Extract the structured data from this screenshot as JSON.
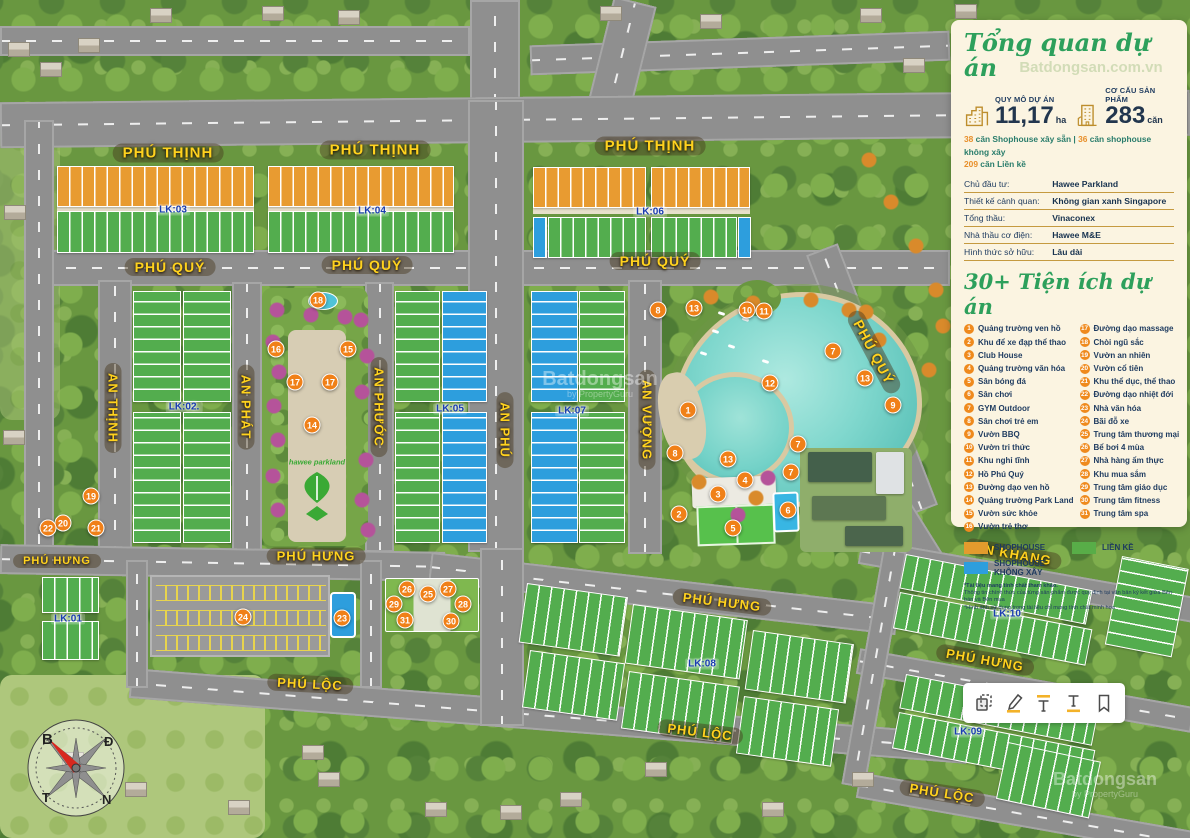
{
  "panel": {
    "title": "Tổng quan dự án",
    "stats": [
      {
        "icon": "city-skyline-icon",
        "label": "QUY MÔ DỰ ÁN",
        "value": "11,17",
        "unit": "ha"
      },
      {
        "icon": "building-icon",
        "label": "CƠ CẤU SẢN PHẨM",
        "value": "283",
        "unit": "căn"
      }
    ],
    "mix": {
      "a_num": "38",
      "a_text": " căn Shophouse xây sẵn",
      "sep": " | ",
      "b_num": "36",
      "b_text": " căn shophouse không xây",
      "c_num": "209",
      "c_text": " căn Liền kề"
    },
    "details": [
      {
        "label": "Chủ đầu tư:",
        "value": "Hawee Parkland"
      },
      {
        "label": "Thiết kế cảnh quan:",
        "value": "Không gian xanh Singapore"
      },
      {
        "label": "Tổng thầu:",
        "value": "Vinaconex"
      },
      {
        "label": "Nhà thầu cơ điện:",
        "value": "Hawee M&E"
      },
      {
        "label": "Hình thức sở hữu:",
        "value": "Lâu dài"
      }
    ],
    "amenities_title": "30+ Tiện ích dự án",
    "amenities": [
      "Quảng trường ven hồ",
      "Khu để xe đạp thể thao",
      "Club House",
      "Quảng trường văn hóa",
      "Sân bóng đá",
      "Sân chơi",
      "GYM Outdoor",
      "Sân chơi trẻ em",
      "Vườn BBQ",
      "Vườn tri thức",
      "Khu nghỉ tĩnh",
      "Hồ Phú Quý",
      "Đường dạo ven hồ",
      "Quảng trường Park Land",
      "Vườn sức khỏe",
      "Vườn trẻ thơ",
      "Đường dạo massage",
      "Chòi ngũ sắc",
      "Vườn an nhiên",
      "Vườn cổ tiên",
      "Khu thể dục, thể thao",
      "Đường dạo nhiệt đới",
      "Nhà văn hóa",
      "Bãi đỗ xe",
      "Trung tâm thương mại",
      "Bể bơi 4 mùa",
      "Nhà hàng ẩm thực",
      "Khu mua sắm",
      "Trung tâm giáo dục",
      "Trung tâm fitness",
      "Trung tâm spa"
    ],
    "legend": [
      {
        "label": "SHOPHOUSE",
        "color": "#e39b2d"
      },
      {
        "label": "LIỀN KỀ",
        "color": "#58ad48"
      },
      {
        "label": "SHOPHOUSE KHÔNG XÂY",
        "color": "#2d9edd"
      }
    ],
    "disclaimer": [
      "*Tài liệu mang tính chất tham khảo.",
      "Thông tin chính thức của từng sản phẩm được quy định tại văn bản ký kết giữa Bên bán và Bên mua",
      "*Hình ảnh sử dụng trong tài liệu chỉ mang tính chất minh họa"
    ]
  },
  "map": {
    "logo": "hawee parkland",
    "compass": {
      "tl": "B",
      "tr": "Đ",
      "bl": "T",
      "br": "N"
    },
    "watermark": {
      "brand": "Batdongsan",
      "domain": ".com.vn",
      "byline": "by PropertyGuru"
    },
    "streets": [
      {
        "t": "PHÚ THỊNH",
        "x": 168,
        "y": 153,
        "r": 0,
        "s": 15
      },
      {
        "t": "PHÚ THỊNH",
        "x": 375,
        "y": 150,
        "r": 0,
        "s": 15
      },
      {
        "t": "PHÚ THỊNH",
        "x": 650,
        "y": 146,
        "r": 0,
        "s": 15
      },
      {
        "t": "PHÚ QUÝ",
        "x": 170,
        "y": 267,
        "r": 0,
        "s": 14
      },
      {
        "t": "PHÚ QUÝ",
        "x": 367,
        "y": 265,
        "r": 0,
        "s": 14
      },
      {
        "t": "PHÚ QUÝ",
        "x": 655,
        "y": 261,
        "r": 0,
        "s": 14
      },
      {
        "t": "PHÚ QUÝ",
        "x": 874,
        "y": 352,
        "r": 62,
        "s": 14
      },
      {
        "t": "AN THỊNH",
        "x": 113,
        "y": 408,
        "r": 90,
        "s": 13
      },
      {
        "t": "AN PHÁT",
        "x": 246,
        "y": 407,
        "r": 90,
        "s": 13
      },
      {
        "t": "AN PHƯỚC",
        "x": 379,
        "y": 407,
        "r": 90,
        "s": 13
      },
      {
        "t": "AN PHÚ",
        "x": 505,
        "y": 430,
        "r": 90,
        "s": 13
      },
      {
        "t": "AN VƯỢNG",
        "x": 647,
        "y": 420,
        "r": 90,
        "s": 13
      },
      {
        "t": "PHÚ HƯNG",
        "x": 57,
        "y": 561,
        "r": 0,
        "s": 11
      },
      {
        "t": "PHÚ HƯNG",
        "x": 316,
        "y": 556,
        "r": 0,
        "s": 13
      },
      {
        "t": "PHÚ HƯNG",
        "x": 722,
        "y": 602,
        "r": 7,
        "s": 13
      },
      {
        "t": "PHÚ HƯNG",
        "x": 985,
        "y": 660,
        "r": 10,
        "s": 13
      },
      {
        "t": "AN KHANG",
        "x": 1013,
        "y": 554,
        "r": 10,
        "s": 13
      },
      {
        "t": "PHÚ LỘC",
        "x": 310,
        "y": 684,
        "r": 3,
        "s": 13
      },
      {
        "t": "PHÚ LỘC",
        "x": 700,
        "y": 732,
        "r": 7,
        "s": 13
      },
      {
        "t": "PHÚ LỘC",
        "x": 942,
        "y": 793,
        "r": 9,
        "s": 13
      }
    ],
    "blocks": [
      {
        "t": "LK:01",
        "x": 68,
        "y": 619
      },
      {
        "t": "LK:02.",
        "x": 184,
        "y": 407
      },
      {
        "t": "LK:03",
        "x": 173,
        "y": 210
      },
      {
        "t": "LK:04",
        "x": 372,
        "y": 211
      },
      {
        "t": "LK:05",
        "x": 450,
        "y": 409
      },
      {
        "t": "LK:06",
        "x": 650,
        "y": 212
      },
      {
        "t": "LK:07",
        "x": 572,
        "y": 411
      },
      {
        "t": "LK:08",
        "x": 702,
        "y": 664
      },
      {
        "t": "LK:09",
        "x": 968,
        "y": 732
      },
      {
        "t": "LK:10",
        "x": 1007,
        "y": 614
      }
    ],
    "markers": [
      [
        1,
        688,
        410
      ],
      [
        2,
        679,
        514
      ],
      [
        3,
        718,
        494
      ],
      [
        4,
        745,
        480
      ],
      [
        5,
        733,
        528
      ],
      [
        6,
        788,
        510
      ],
      [
        7,
        833,
        351
      ],
      [
        7,
        798,
        444
      ],
      [
        7,
        791,
        472
      ],
      [
        8,
        658,
        310
      ],
      [
        8,
        675,
        453
      ],
      [
        9,
        893,
        405
      ],
      [
        10,
        747,
        310
      ],
      [
        11,
        764,
        311
      ],
      [
        12,
        770,
        383
      ],
      [
        13,
        694,
        308
      ],
      [
        13,
        865,
        378
      ],
      [
        13,
        728,
        459
      ],
      [
        14,
        312,
        425
      ],
      [
        15,
        348,
        349
      ],
      [
        16,
        276,
        349
      ],
      [
        17,
        295,
        382
      ],
      [
        17,
        330,
        382
      ],
      [
        18,
        318,
        300
      ],
      [
        19,
        91,
        496
      ],
      [
        20,
        63,
        523
      ],
      [
        21,
        96,
        528
      ],
      [
        22,
        48,
        528
      ],
      [
        23,
        342,
        618
      ],
      [
        24,
        243,
        617
      ],
      [
        25,
        428,
        594
      ],
      [
        26,
        407,
        589
      ],
      [
        27,
        448,
        589
      ],
      [
        28,
        463,
        604
      ],
      [
        29,
        394,
        604
      ],
      [
        30,
        451,
        621
      ],
      [
        31,
        405,
        620
      ]
    ]
  },
  "toolbar": {
    "tools": [
      "copy-icon",
      "highlight-pen-icon",
      "text-highlight-icon",
      "text-underline-icon",
      "bookmark-icon"
    ]
  }
}
